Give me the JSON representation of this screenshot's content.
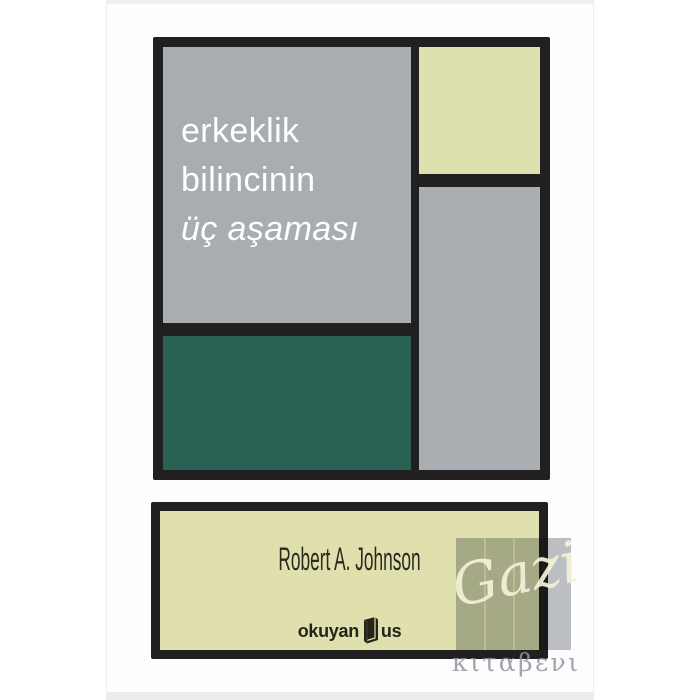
{
  "product_image": {
    "book_cover": {
      "title_lines": [
        "erkeklik",
        "bilincinin",
        "üç aşaması"
      ],
      "author": "Robert A. Johnson",
      "publisher_logo": {
        "left_word": "okuyan",
        "right_word": "us",
        "icon": "book-icon"
      },
      "palette": {
        "frame_black": "#221f20",
        "gray_block": "#a9acb0",
        "green_block": "#2a6154",
        "cream_block": "#dee0ae",
        "author_panel": "#dfe0ad",
        "title_text": "#fefefe",
        "author_text": "#2b2a20"
      }
    },
    "watermark": {
      "script_text": "Gazi",
      "caption_text": "κιταβενι",
      "overlay_color": "rgba(123,131,141,0.5)",
      "script_color": "#f3f1d6",
      "caption_color": "#8d949e"
    }
  }
}
